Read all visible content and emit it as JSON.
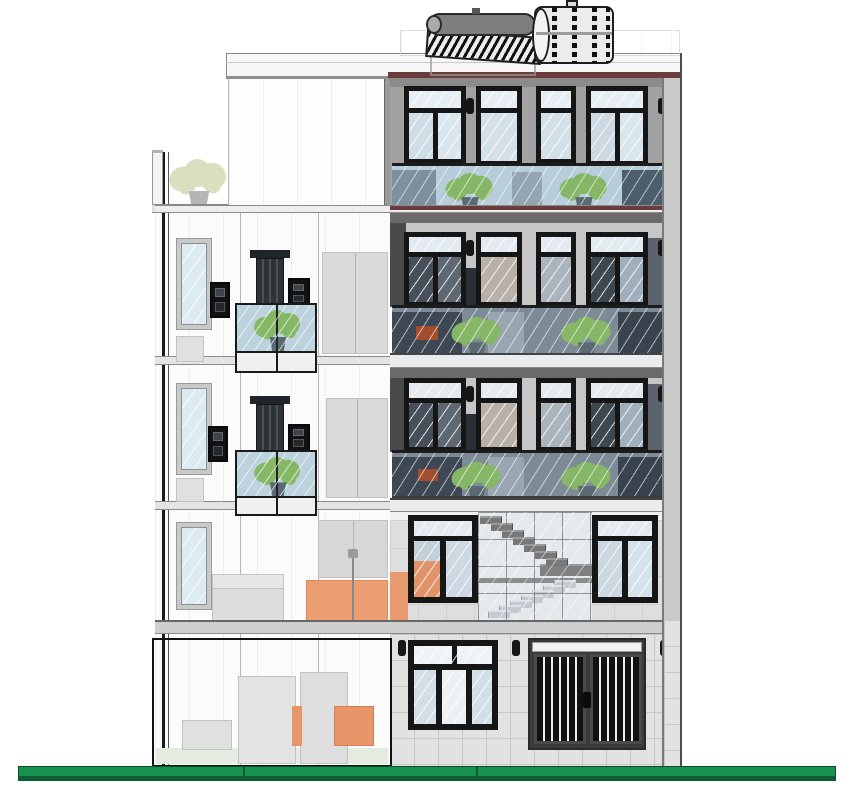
{
  "document": {
    "type": "architectural elevation/section drawing",
    "subject": "five-storey townhouse, side elevation with cut section",
    "visible_text": ""
  },
  "colors": {
    "frame_black": "#161616",
    "glass_light": "#d8e4ec",
    "glass_mid": "#b7cdd9",
    "glass_dark": "#46525d",
    "wall_gray": "#a2a2a2",
    "wall_light": "#c8c8c8",
    "slab_maroon": "#6b3c3c",
    "ground_green": "#17914e",
    "ground_green_dark": "#0d5c32",
    "plant_green": "#86b766",
    "plant_pale": "#d9e0c0",
    "pot_gray": "#5a6a72",
    "furniture_orange": "#ec9e72",
    "gate_gray": "#4a4a4a",
    "metal_gray": "#787878"
  },
  "building": {
    "storeys": 5,
    "front_balconies": 3,
    "front_balcony_plants": 6,
    "terrace_plants": 3,
    "side_balconies": 2,
    "roof_equipment": [
      "solar-water-heater",
      "water-storage-tank"
    ],
    "ground_floor": [
      "entry-window",
      "garage-gate"
    ],
    "second_floor": [
      "window",
      "staircase-glass-wall",
      "window"
    ]
  },
  "stairs": {
    "upper_steps": 7,
    "lower_steps": 7
  },
  "ground_line": {
    "present": true
  }
}
